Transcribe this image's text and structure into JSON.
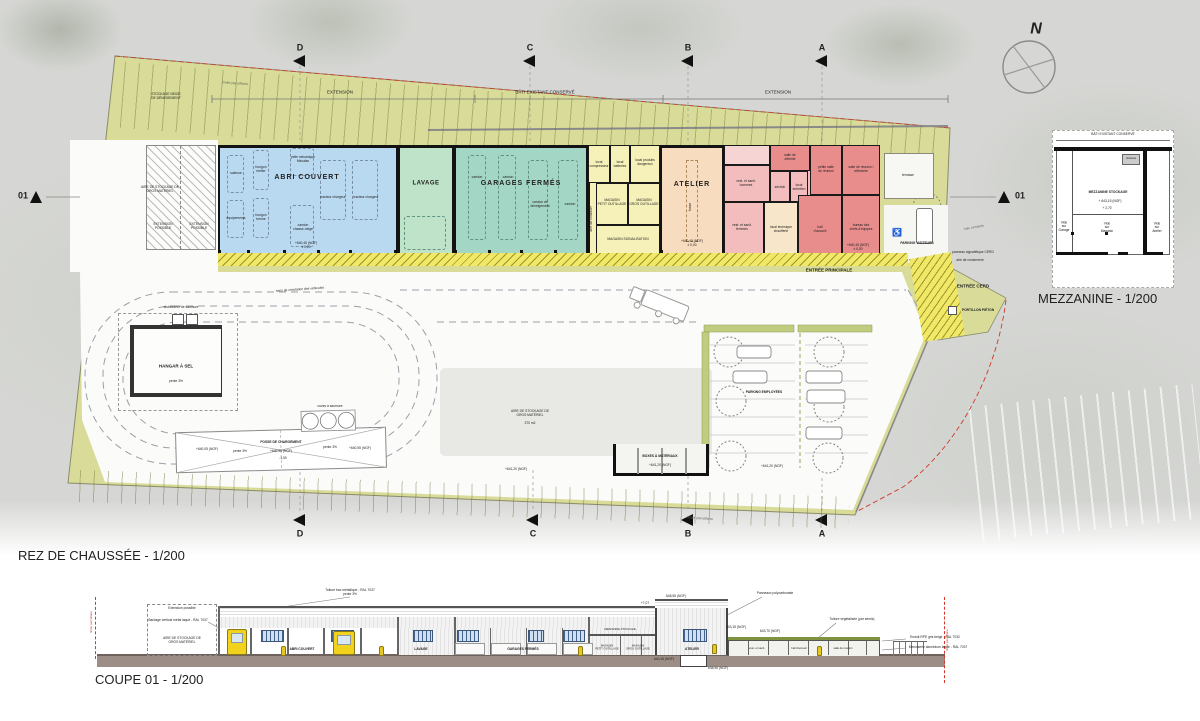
{
  "titles": {
    "plan": "REZ DE CHAUSSÉE - 1/200",
    "section": "COUPE 01 - 1/200",
    "mezzanine": "MEZZANINE - 1/200"
  },
  "compass": {
    "north": "N"
  },
  "markers": {
    "a": "A",
    "b": "B",
    "c": "C",
    "d": "D",
    "cut": "01"
  },
  "dimensions": {
    "extension": "EXTENSION",
    "bati_existant": "BÂTI EXISTANT CONSERVÉ"
  },
  "site": {
    "stockage_neige": "STOCKAGE NEIGE\nDE DÉNEIGEMENT",
    "limite_parcellaire": "limite parcellaire",
    "haie_existante": "haie existante",
    "aire_stockage": "AIRE DE STOCKAGE DE\nGROS MATÉRIEL",
    "extension_possible": "EXTENSION\nPOSSIBLE",
    "hangar_sel": "HANGAR À SEL",
    "pente_3": "pente 3%",
    "distributeur_saumure": "distributeur de saumure",
    "cuves_saumure": "cuves à saumure",
    "fosse_chargement": "FOSSE DE CHARGEMENT",
    "niveau_640_05": "+640,05 (NGF)",
    "niveau_640_55": "+640,55 (NGF)",
    "profondeur_150": "-1,50",
    "sens_circulation": "sens de circulation des véhicules",
    "aire_370": "370 m2",
    "boxes_materiaux": "BOXES À MATÉRIAUX",
    "niveau_641_20": "+641,20 (NGF)",
    "parking_employees": "PARKING EMPLOYÉES",
    "parking_visiteurs": "PARKING VISITEURS",
    "terrasse": "terrasse",
    "entree_principale": "ENTRÉE PRINCIPALE",
    "entree_cerd": "ENTRÉE CERD",
    "portillon_pieton": "PORTILLON PIÉTON",
    "panneau_signaletique": "panneau signalétique CERD",
    "aire_croisement": "aire de croisement",
    "niveau_640_45": "+640,45 (NGF)\n± 0,00"
  },
  "building": {
    "abri_couvert": "ABRI COUVERT",
    "lavage": "LAVAGE",
    "garages_fermes": "GARAGES FERMÉS",
    "atelier": "ATELIER",
    "saleuse": "saleuse",
    "equipements": "équipements",
    "fourgon_metier": "fourgon\nmétier",
    "fourgon_benne": "fourgon\nbenne",
    "pelle_mecanique": "pelle mécanique\nMécalac",
    "camion_chasse": "camion\nchasse-neige",
    "tracteur_chargeur": "tracteur chargeur",
    "camion": "camion",
    "camion_deneigement": "camion de\ndéneigement",
    "local_compresseur": "local\ncompresseur",
    "local_batteries": "local\nbatteries",
    "local_produits": "local produits\ndangereux",
    "magasin_petit": "MAGASIN\nPETIT OUTILLAGE",
    "magasin_gros": "MAGASIN\nGROS OUTILLAGE",
    "magasin_signalisation": "MAGASIN SIGNALISATION",
    "aire_livraison": "aire de livraison",
    "fosse": "fosse",
    "vestiaires_h": "vest. et sanit.\nhommes",
    "vestiaires_f": "vest. et sanit.\nfemmes",
    "sechoir": "séchoir",
    "local_entretien": "local\nentretien",
    "salle_detente": "salle de\ndétente",
    "chaufferie": "local technique\nchaufferie",
    "hall_accueil": "hall\nd'accueil",
    "salle_reunion": "salle de réunion /\nréfectoire",
    "petite_salle": "petite salle\nde réunion",
    "bureau_chefs": "bureau des\nchefs d'équipes"
  },
  "mezzanine": {
    "bati": "BÂTI EXISTANT CONSERVÉ",
    "chassis": "châssis",
    "stockage": "MEZZANINE STOCKAGE",
    "niveau": "+ 643,15 (NGF)",
    "hauteur": "+ 2,70",
    "vide_garage": "Vide\nsur\nGarage",
    "vide_magasin": "Vide\nsur\nMagasin",
    "vide_atelier": "Vide\nsur\nAtelier"
  },
  "section": {
    "toiture_metal": "Toiture bac métallique - RAL 7037\npente 3%",
    "bardage": "Bardage vertical métal laqué - RAL 7037",
    "extension_possible": "Extension possible",
    "aire_stockage": "AIRE DE STOCKAGE DE\nGROS MATÉRIEL",
    "abri": "ABRI COUVERT",
    "lavage": "LAVAGE",
    "garages": "GARAGES FERMÉS",
    "atelier": "ATELIER",
    "mezzanine_stockage": "MEZZANINE STOCKAGE",
    "magasin_petit": "MAGASIN\nPETIT OUTILLAGE",
    "magasin_gros": "MAGASIN\nGROS OUTILLAGE",
    "vestiaires": "vest. et sanit.",
    "hall": "hall d'accueil",
    "salle_reunion": "salle de réunion",
    "polycarbonate": "Panneaux polycarbonate",
    "toiture_vegetalisee": "Toiture végétalisée (par semis)",
    "enduit": "Enduit RPE gris beige - RAL 7032",
    "menuiserie": "Menuiserie aluminium laqué - RAL 7037",
    "lvl_648": "648,55 (NGF)",
    "lvl_6437": "643,70 (NGF)",
    "lvl_64315": "643,15 (NGF)",
    "lvl_64045": "640,45 (NGF)",
    "lvl_63895": "638,95 (NGF)",
    "dim_707": "+7,07",
    "limite": "limite parcellaire"
  },
  "colors": {
    "parcel_green": "#d8dc98",
    "abri_blue": "#b9d9f1",
    "lavage_green": "#bfe3c9",
    "garages_teal": "#a4d6c5",
    "magasins_yellow": "#f6f1b8",
    "atelier_peach": "#f8dcc0",
    "rooms_red": "#e98c8c",
    "rooms_pink": "#f3bdbd",
    "canopy_yellow": "#f1e866",
    "ground_brown": "#9c8d86"
  }
}
